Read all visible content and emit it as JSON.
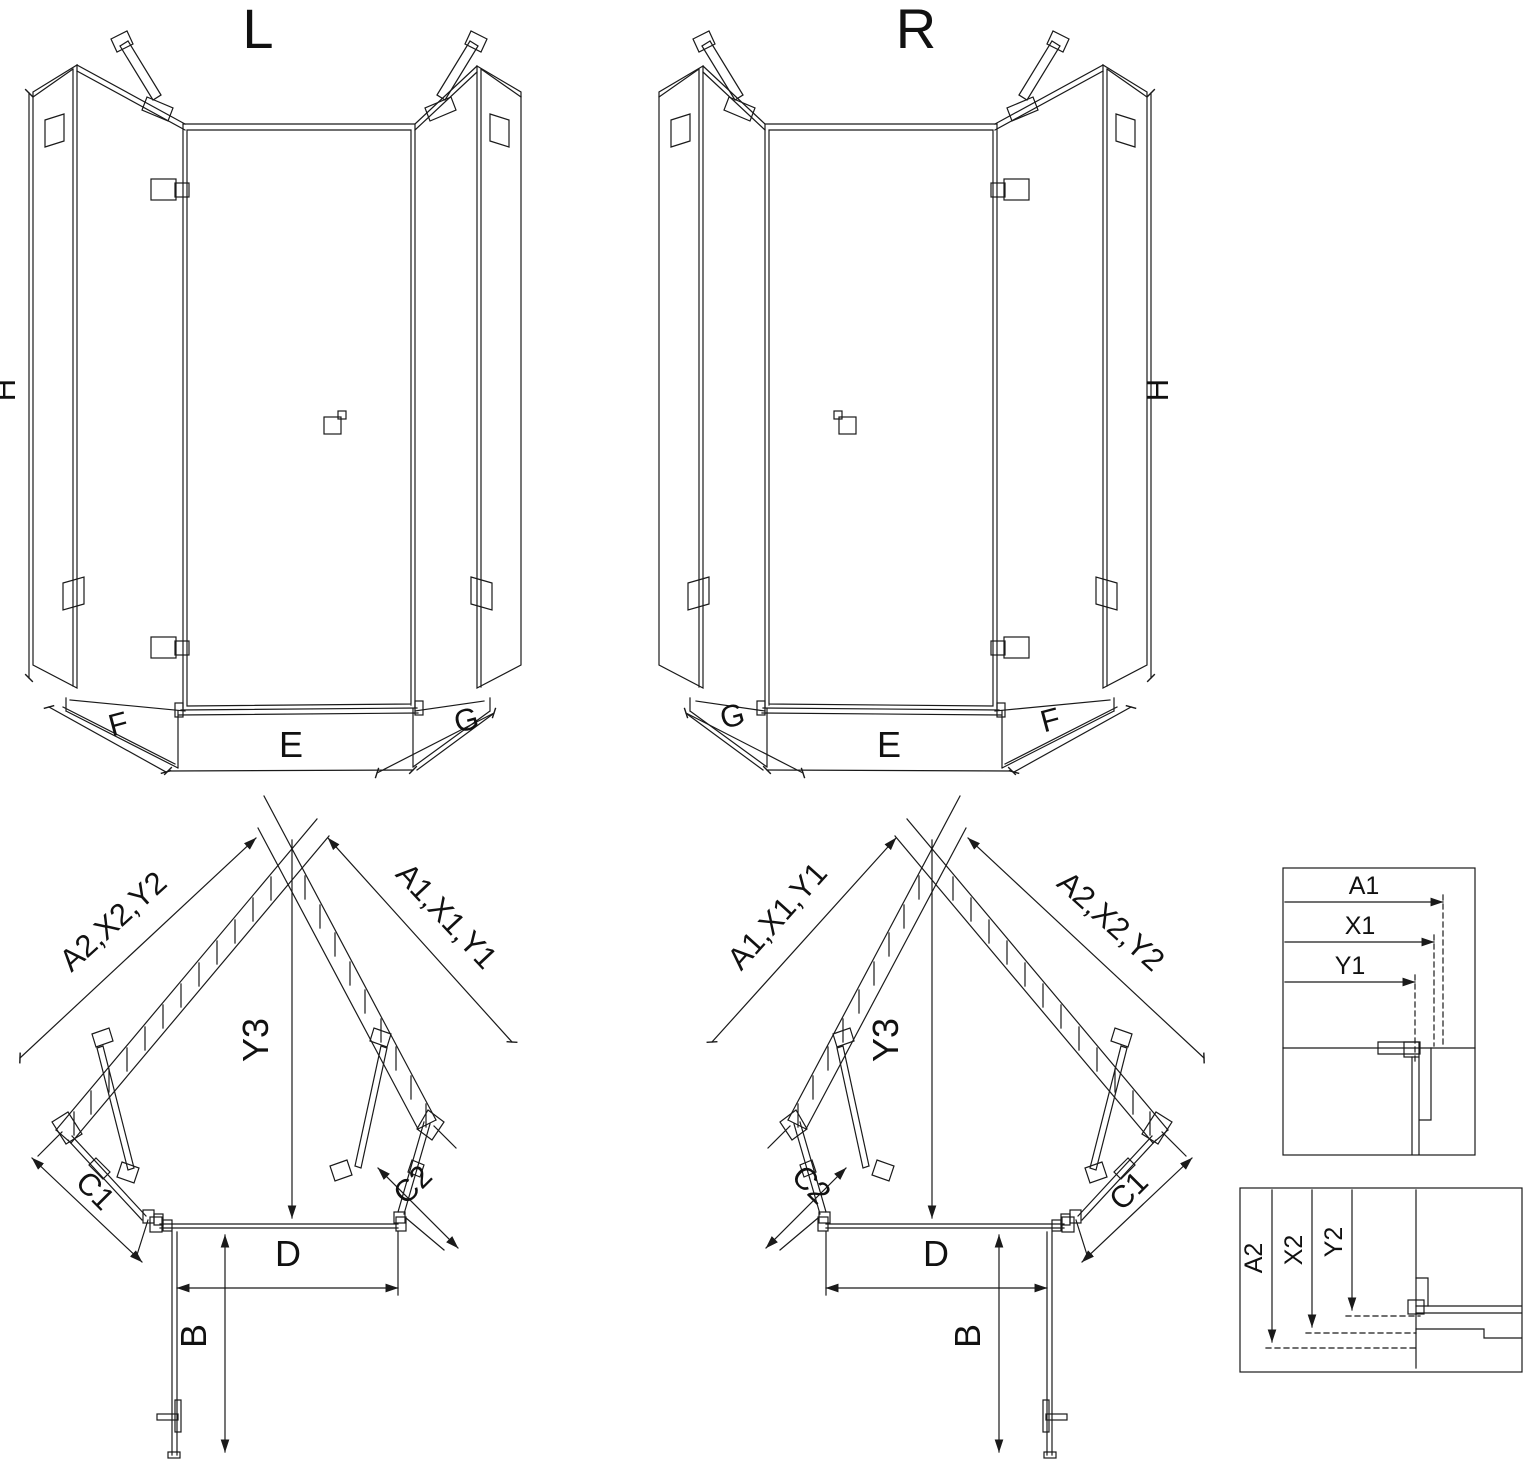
{
  "colors": {
    "ink": "#1a1a1a",
    "background": "#ffffff"
  },
  "iso_left": {
    "title": "L",
    "dim_height": "H",
    "dim_left_panel": "F",
    "dim_front": "E",
    "dim_right_panel": "G"
  },
  "iso_right": {
    "title": "R",
    "dim_height": "H",
    "dim_left_panel": "G",
    "dim_front": "E",
    "dim_right_panel": "F"
  },
  "plan_left": {
    "dim_wall_left": "A2,X2,Y2",
    "dim_wall_right": "A1,X1,Y1",
    "dim_depth": "Y3",
    "dim_corner_left": "C1",
    "dim_corner_right": "C2",
    "dim_door": "D",
    "dim_door_open": "B"
  },
  "plan_right": {
    "dim_wall_left": "A1,X1,Y1",
    "dim_wall_right": "A2,X2,Y2",
    "dim_depth": "Y3",
    "dim_corner_left": "C2",
    "dim_corner_right": "C1",
    "dim_door": "D",
    "dim_door_open": "B"
  },
  "detail_wall_right": {
    "dim_a": "A1",
    "dim_x": "X1",
    "dim_y": "Y1"
  },
  "detail_wall_bottom": {
    "dim_a": "A2",
    "dim_x": "X2",
    "dim_y": "Y2"
  }
}
